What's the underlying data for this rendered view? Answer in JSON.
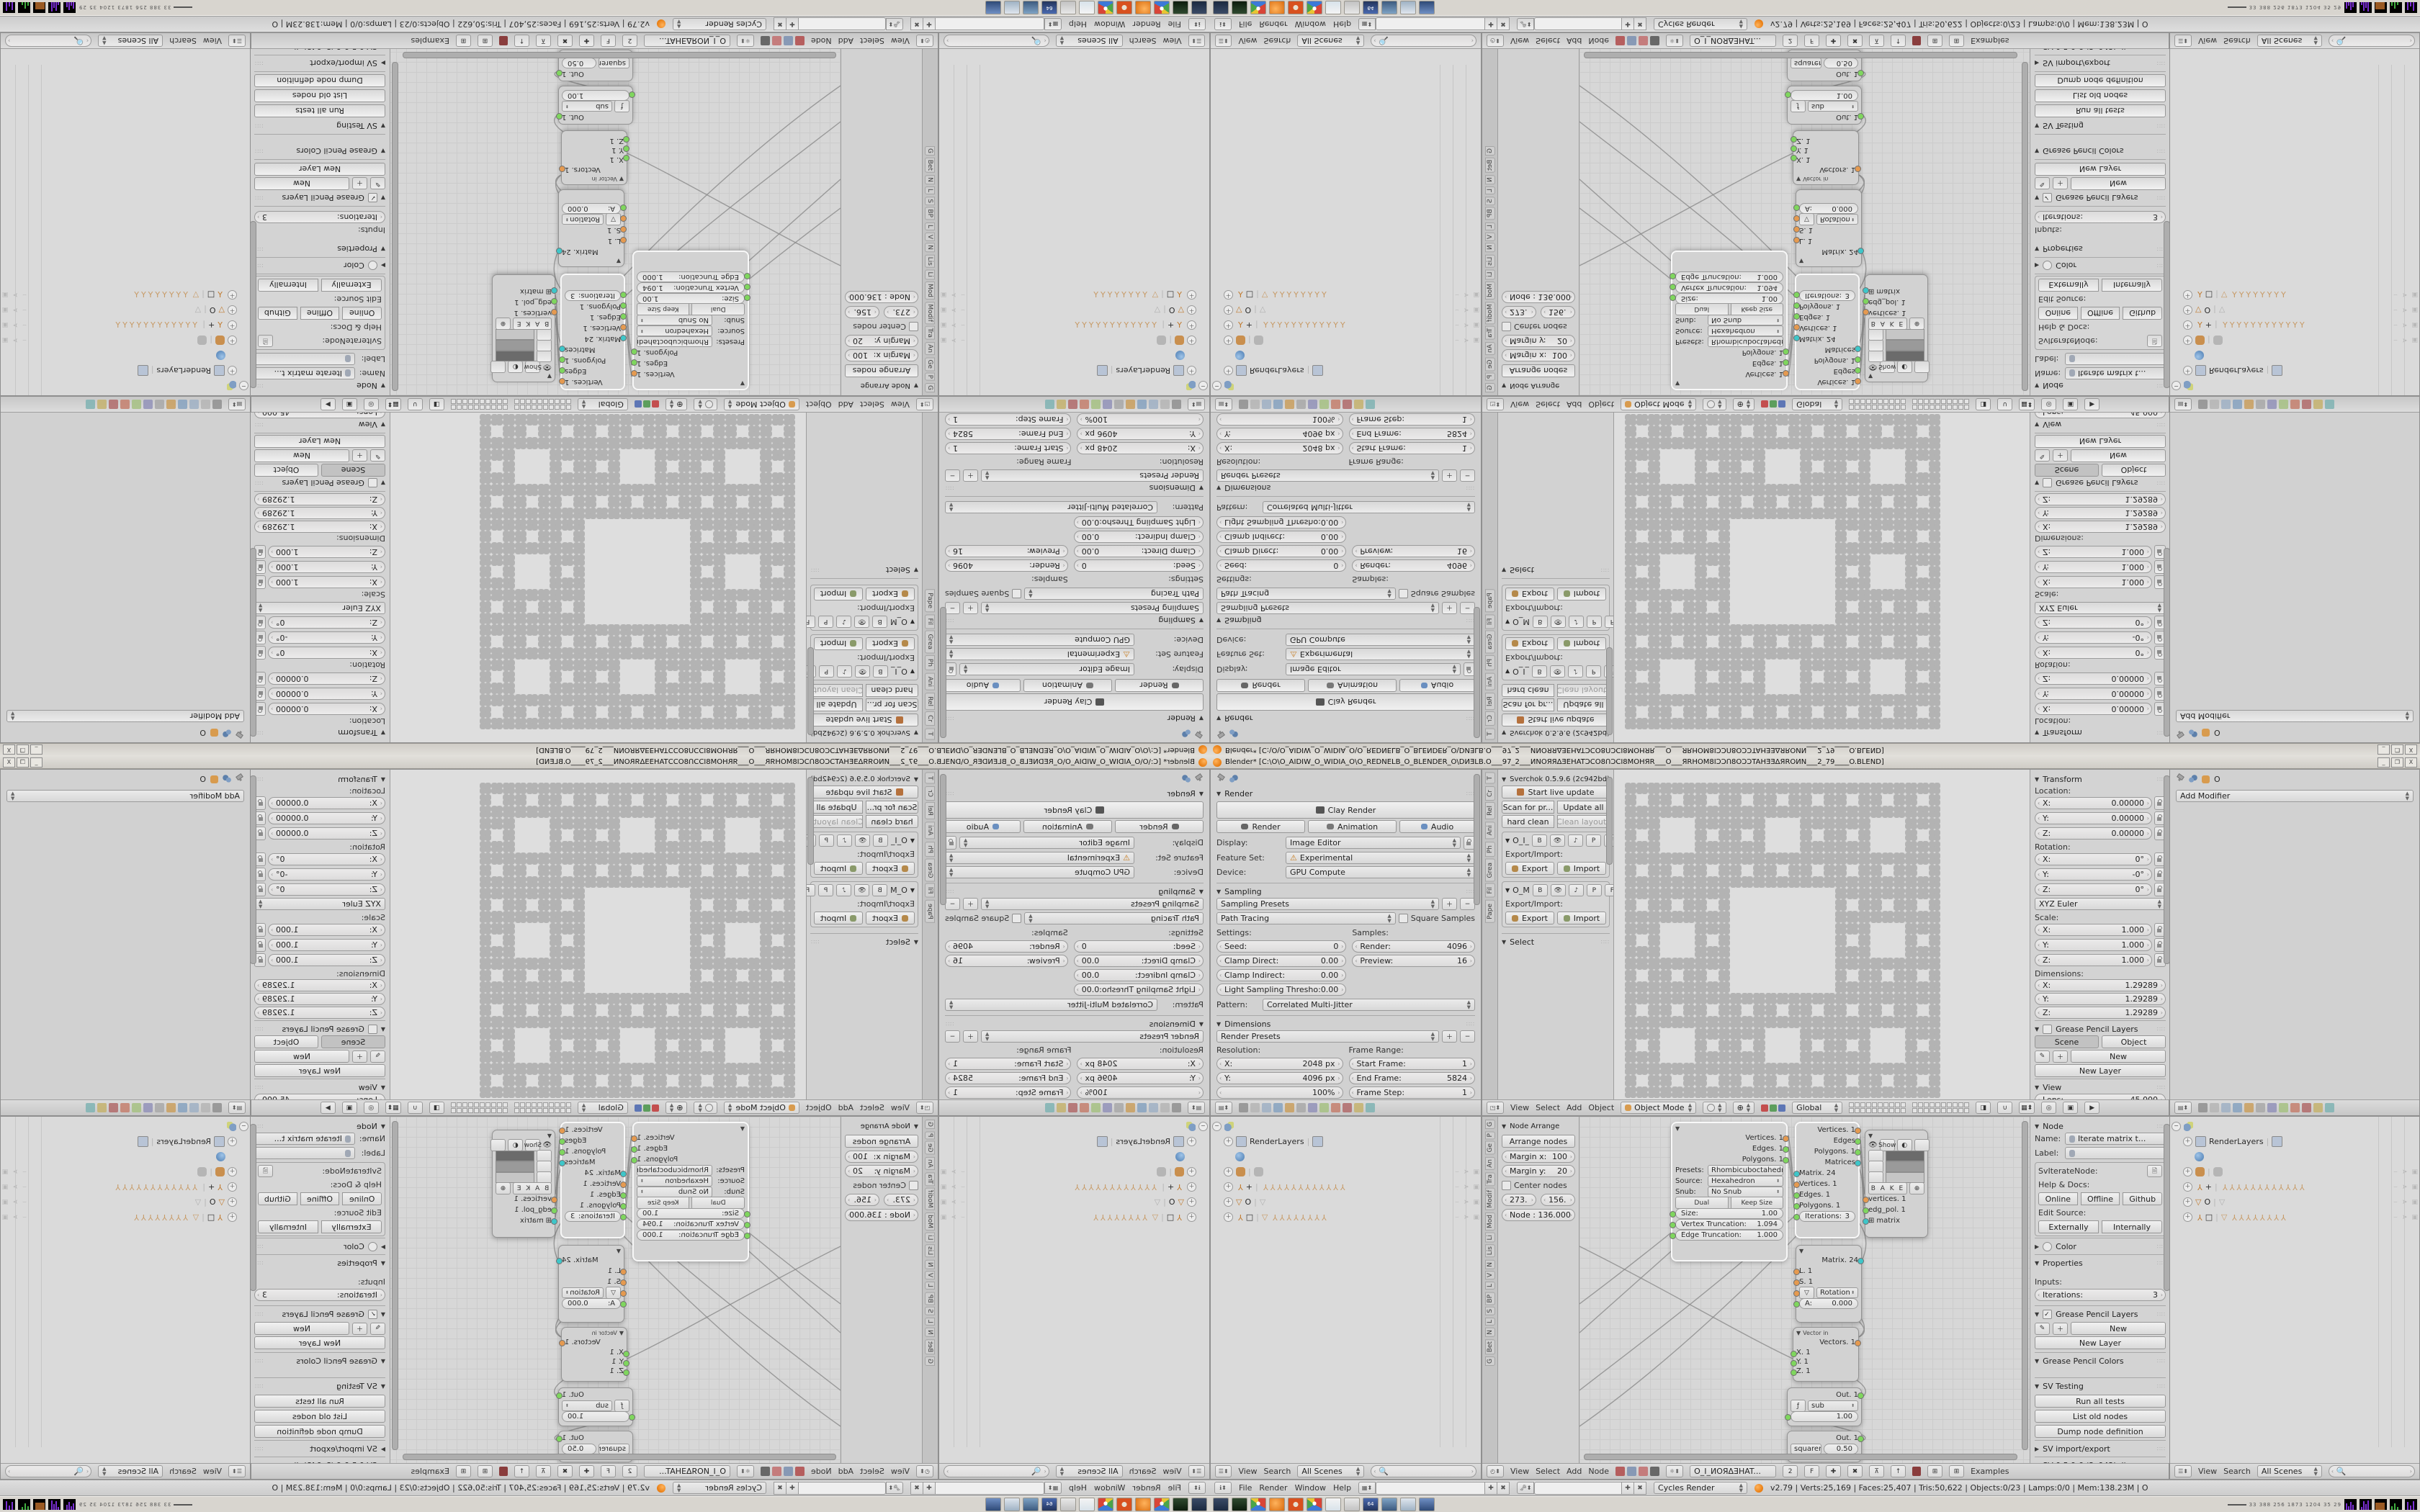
{
  "window": {
    "title": "Blender* [C:\\O\\O_AIDIW_O_WIDIA_O\\O_REDNELB_O_BLENDER_O\\DИƎLB.O___97_2___ИNOЯЯΔƎEHATƆCO8ՈƆCI8MOHЯR___O___ЯRHOM8IƆƆՈ8OƆƆTAHƎƎΔЯROИN___2_79____O.BLEND]",
    "minimize": "_",
    "restore": "❐",
    "close": "X"
  },
  "infobar": {
    "menus": [
      "File",
      "Render",
      "Window",
      "Help"
    ],
    "engine": "Cycles Render",
    "stats": "v2.79 | Verts:25,169 | Faces:25,407 | Tris:50,622 | Objects:0/23 | Lamps:0/0 | Mem:138.23M | O"
  },
  "taskbar": {
    "tray_numbers": "33  388  256  1873 1204  35    29"
  },
  "props_render": {
    "render": {
      "title": "Render",
      "clay": "Clay Render",
      "render_btn": "Render",
      "animation_btn": "Animation",
      "audio_btn": "Audio",
      "display_label": "Display:",
      "display": "Image Editor",
      "feature_label": "Feature Set:",
      "feature": "Experimental",
      "device_label": "Device:",
      "device": "GPU Compute"
    },
    "sampling": {
      "title": "Sampling",
      "presets": "Sampling Presets",
      "integrator": "Path Tracing",
      "square": "Square Samples",
      "settings_label": "Settings:",
      "seed_label": "Seed:",
      "seed": "0",
      "clamp_direct_label": "Clamp Direct:",
      "clamp_direct": "0.00",
      "clamp_indirect_label": "Clamp Indirect:",
      "clamp_indirect": "0.00",
      "light_label": "Light Sampling Thresho:",
      "light": "0.00",
      "samples_label": "Samples:",
      "render_label": "Render:",
      "render": "4096",
      "preview_label": "Preview:",
      "preview": "16",
      "pattern_label": "Pattern:",
      "pattern": "Correlated Multi-Jitter"
    },
    "dimensions": {
      "title": "Dimensions",
      "presets": "Render Presets",
      "resolution_label": "Resolution:",
      "x_label": "X:",
      "x": "2048 px",
      "y_label": "Y:",
      "y": "4096 px",
      "percent": "100%",
      "range_label": "Frame Range:",
      "start_label": "Start Frame:",
      "start": "1",
      "end_label": "End Frame:",
      "end": "5824",
      "step_label": "Frame Step:",
      "step": "1",
      "aspect_label": "Aspect Ratio:",
      "framerate_label": "Frame Rate:"
    }
  },
  "viewport": {
    "tabs": [
      "T",
      "Cr",
      "Rel",
      "Ani",
      "Ph",
      "Grea",
      "Fil",
      "Pape"
    ],
    "shelf": {
      "title": "Sverchok 0.5.9.6 (2c942bd)",
      "live_update": "Start live update",
      "scan": "Scan for pr...",
      "update_all": "Update all",
      "hard_clean": "hard clean",
      "clean_layouts": "Clean layouts",
      "tree1": "O_I_",
      "tree2": "O_M",
      "tg_b": "B",
      "tg_p": "P",
      "tg_f": "F",
      "exp_label": "Export/Import:",
      "export": "Export",
      "import": "Import",
      "select_title": "Select"
    },
    "header": {
      "menus": [
        "View",
        "Select",
        "Add",
        "Object"
      ],
      "mode": "Object Mode",
      "orientation": "Global"
    },
    "npanel": {
      "transform": "Transform",
      "location_label": "Location:",
      "axes": [
        "X:",
        "Y:",
        "Z:"
      ],
      "loc": [
        "0.00000",
        "0.00000",
        "0.00000"
      ],
      "rotation_label": "Rotation:",
      "rot": [
        "0°",
        "-0°",
        "0°"
      ],
      "euler": "XYZ Euler",
      "scale_label": "Scale:",
      "scale": [
        "1.000",
        "1.000",
        "1.000"
      ],
      "dim_label": "Dimensions:",
      "dims": [
        "1.29289",
        "1.29289",
        "1.29289"
      ],
      "gp_layers": "Grease Pencil Layers",
      "scene_tab": "Scene",
      "object_tab": "Object",
      "new": "New",
      "new_layer": "New Layer",
      "view_title": "View",
      "lens_label": "Lens:",
      "lens": "45.000",
      "lock_label": "Lock to Object:"
    }
  },
  "props_modifier": {
    "object_name": "O",
    "add_modifier": "Add Modifier"
  },
  "outliner": {
    "rows": {
      "renderlayers": "RenderLayers",
      "armature_plus": "+",
      "tri_o": "O",
      "armature_box": "□",
      "bones12": "YYYYYYYYYYYY",
      "bones8": "YYYYYYYY",
      "bone1": "Y"
    },
    "header": {
      "view": "View",
      "search": "Search",
      "scenes": "All Scenes"
    }
  },
  "node_editor": {
    "tabs": [
      "G",
      "P",
      "Ge",
      "An",
      "Tra",
      "Modif",
      "Mod",
      "Li",
      "Lis",
      "N",
      "V",
      "L",
      "BP",
      "S",
      "L",
      "N",
      "Bet",
      "G"
    ],
    "shelf": {
      "title": "Node Arrange",
      "arrange": "Arrange nodes",
      "mx_label": "Margin x:",
      "mx": "100",
      "my_label": "Margin y:",
      "my": "20",
      "center": "Center nodes",
      "b1": "273.",
      "b2": "156.",
      "node_info": "Node : 136.000"
    },
    "header": {
      "menus": [
        "View",
        "Select",
        "Add",
        "Node"
      ],
      "tree_name": "O_I_ИОЯΔƎHAT...",
      "users": "2",
      "fake": "F",
      "examples": "Examples"
    },
    "npanel": {
      "node_title": "Node",
      "name_label": "Name:",
      "name": "Iterate matrix t...",
      "label_label": "Label:",
      "idname_label": "SvIterateNode:",
      "help_label": "Help & Docs:",
      "online": "Online",
      "offline": "Offline",
      "github": "Github",
      "edit_label": "Edit Source:",
      "externally": "Externally",
      "internally": "Internally",
      "color": "Color",
      "properties": "Properties",
      "inputs_label": "Inputs:",
      "iterations_label": "Iterations:",
      "iterations": "3",
      "gp_layers": "Grease Pencil Layers",
      "new": "New",
      "new_layer": "New Layer",
      "gp_colors": "Grease Pencil Colors",
      "sv_testing": "SV Testing",
      "run_tests": "Run all tests",
      "list_old": "List old nodes",
      "dump": "Dump node definition",
      "sv_ie": "SV import/export",
      "sv_ver": "SV 0.5.9.6 (2c942bd)"
    },
    "nodes": {
      "rhombi": {
        "presets_label": "Presets:",
        "presets": "Rhombicuboctahedron",
        "source_label": "Source:",
        "source": "Hexahedron",
        "snub_label": "Snub:",
        "snub": "No Snub",
        "dual": "Dual",
        "keep": "Keep Size",
        "size_label": "Size:",
        "size": "1.00",
        "vt_label": "Vertex Truncation:",
        "vt": "1.094",
        "et_label": "Edge Truncation:",
        "et": "1.000",
        "out1": "Vertices. 1",
        "out2": "Edges. 1",
        "out3": "Polygons. 1"
      },
      "iterate": {
        "out1": "Vertices. 1",
        "out2": "Edges",
        "out3": "Polygons. 1",
        "out4": "Matrices",
        "in1": "Matrix. 24",
        "in2": "Vertices. 1",
        "in3": "Edges. 1",
        "in4": "Polygons. 1",
        "iter_label": "Iterations:",
        "iter": "3"
      },
      "viewer": {
        "show": "Show",
        "bake": "B A K E",
        "in1": "vertices. 1",
        "in2": "edg_pol. 1",
        "in3": "matrix"
      },
      "matrixin": {
        "out": "Matrix. 24",
        "in1": "L. 1",
        "in2": "S. 1",
        "rot": "Rotation",
        "a_label": "A:",
        "a": "0.000"
      },
      "vectorin": {
        "title": "Vector in",
        "out": "Vectors. 1",
        "in1": "X. 1",
        "in2": "Y. 1",
        "in3": "Z. 1"
      },
      "sub": {
        "out": "Out. 1",
        "fn": "sub",
        "value": "1.00"
      },
      "sqrt": {
        "out": "Out. 1",
        "fn": "squareroot",
        "value": "0.50"
      }
    }
  },
  "colors": {
    "socket_green": "#7fd65e",
    "socket_orange": "#e59a50",
    "socket_teal": "#3ec6c9",
    "blender_orange": "#e87d12",
    "warning": "#e8a33d"
  }
}
